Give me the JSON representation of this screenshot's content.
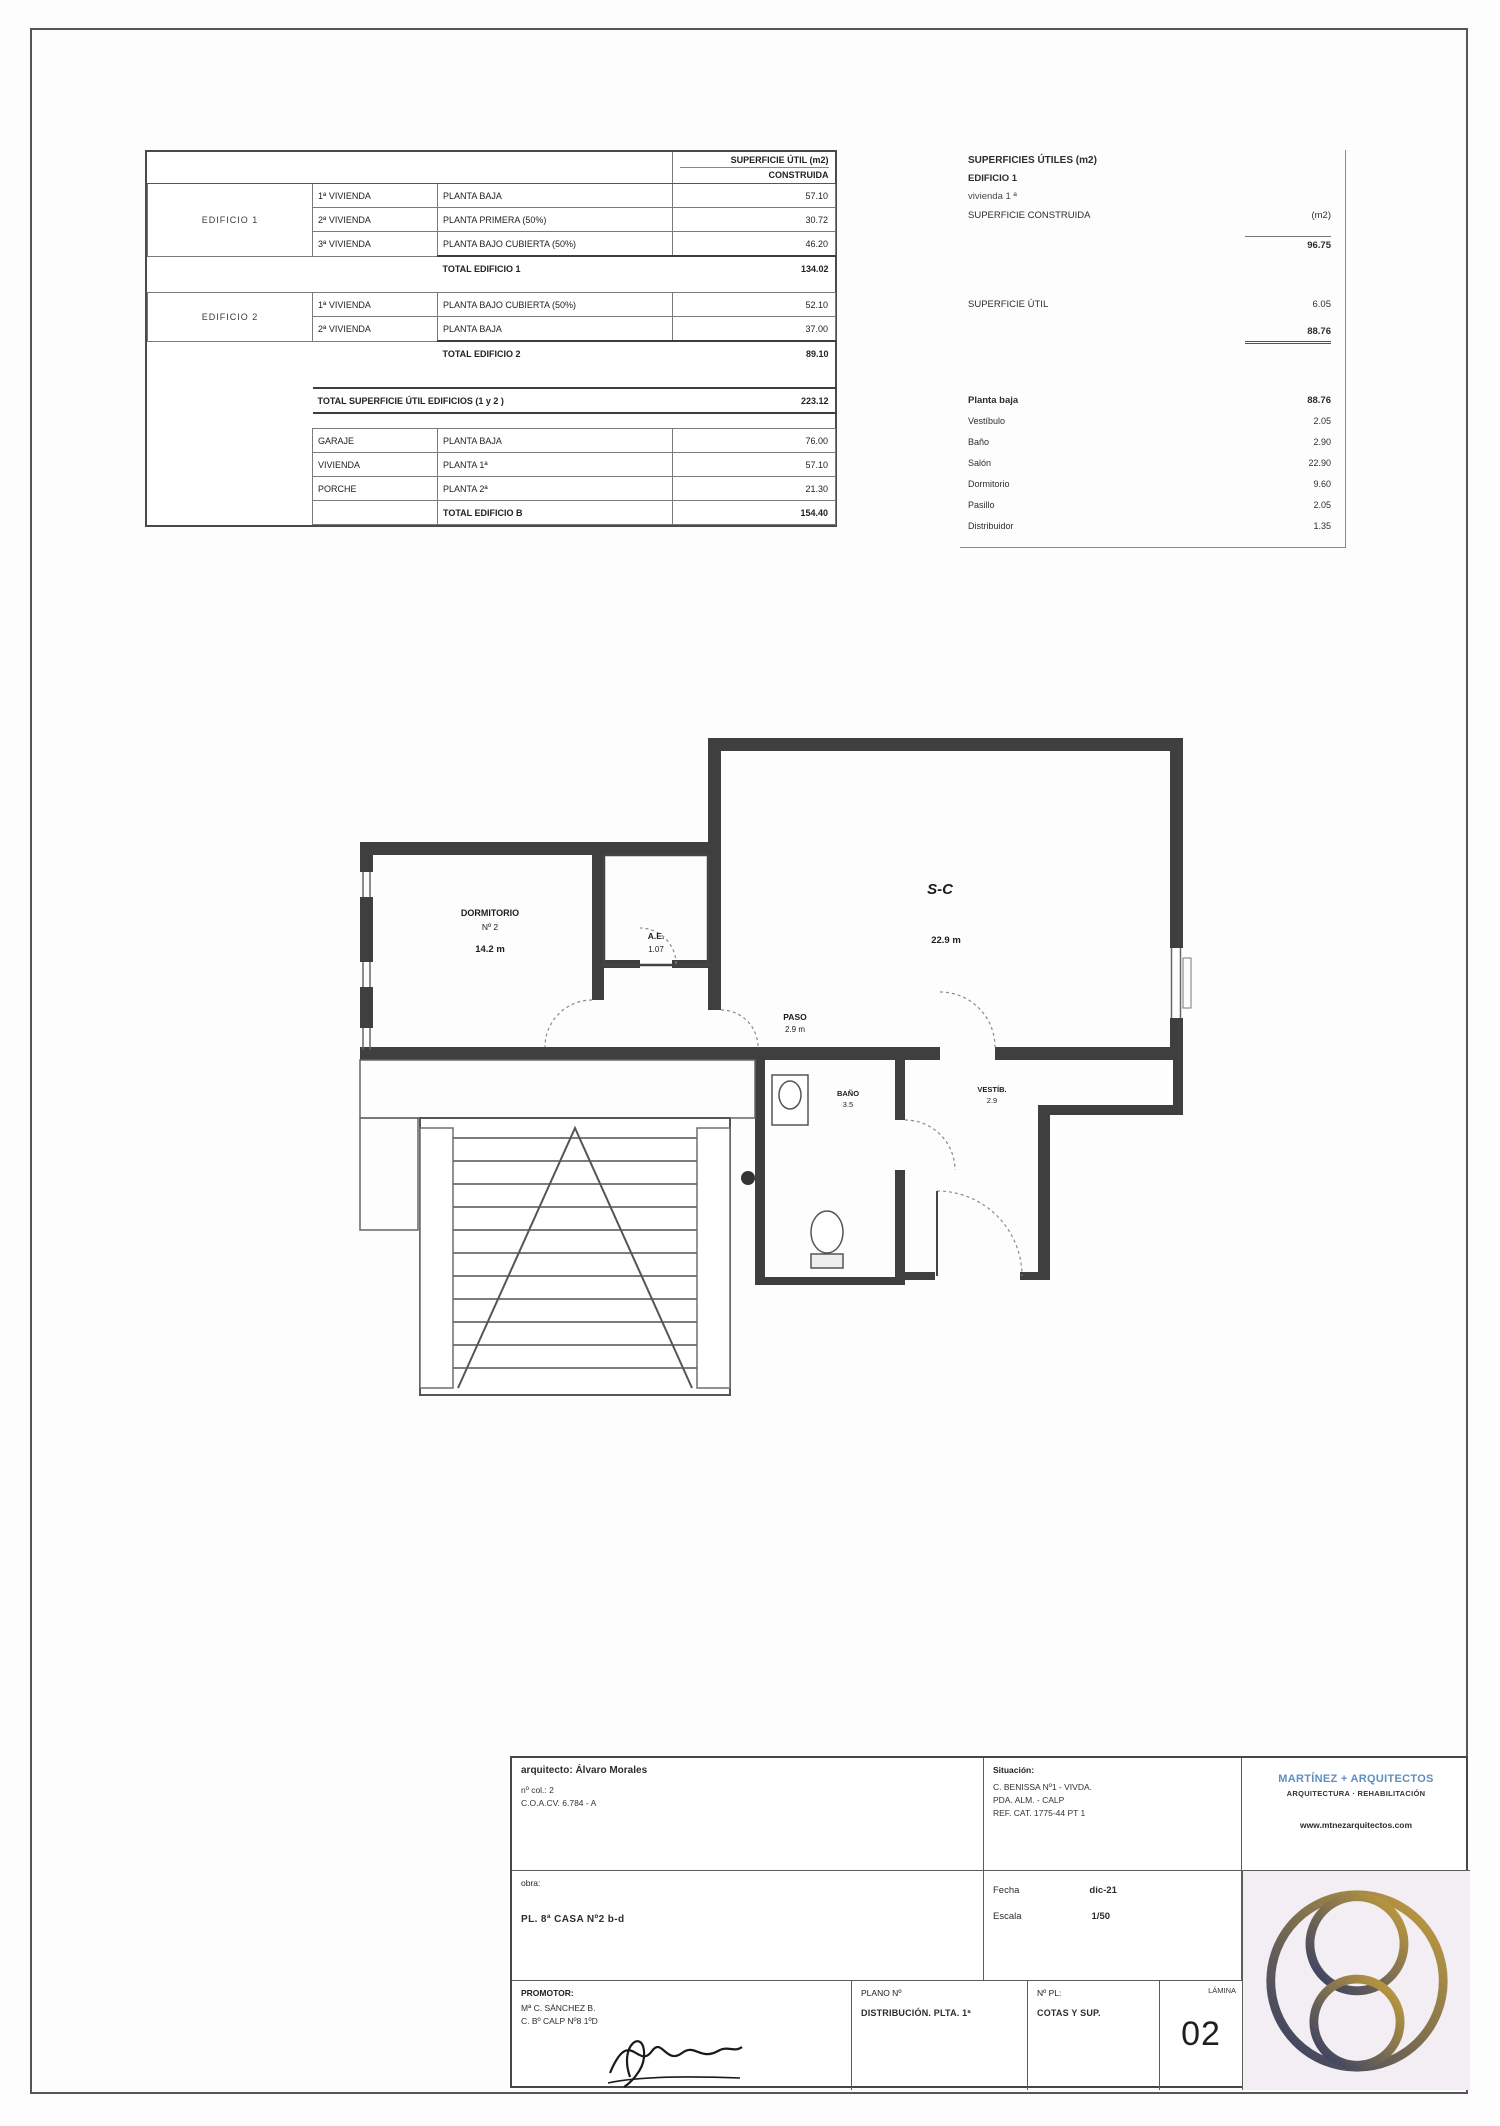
{
  "colors": {
    "firm_blue": "#5f8fc0",
    "logo_gold": "#c9a23b",
    "logo_navy": "#303a66",
    "wall": "#3f3f3f"
  },
  "surface_table": {
    "header": {
      "line1": "SUPERFICIE ÚTIL (m2)",
      "line2": "CONSTRUIDA"
    },
    "sec1": {
      "name": "EDIFICIO 1",
      "r1": {
        "unit": "1ª VIVIENDA",
        "desc": "PLANTA BAJA",
        "value": "57.10"
      },
      "r2": {
        "unit": "2ª VIVIENDA",
        "desc": "PLANTA PRIMERA (50%)",
        "value": "30.72"
      },
      "r3": {
        "unit": "3ª VIVIENDA",
        "desc": "PLANTA BAJO CUBIERTA (50%)",
        "value": "46.20"
      },
      "total_label": "TOTAL EDIFICIO 1",
      "total_value": "134.02"
    },
    "sec2": {
      "name": "EDIFICIO 2",
      "r1": {
        "unit": "1ª VIVIENDA",
        "desc": "PLANTA BAJO CUBIERTA (50%)",
        "value": "52.10"
      },
      "r2": {
        "unit": "2ª VIVIENDA",
        "desc": "PLANTA BAJA",
        "value": "37.00"
      },
      "total_label": "TOTAL EDIFICIO 2",
      "total_value": "89.10"
    },
    "grand": {
      "label": "TOTAL SUPERFICIE ÚTIL EDIFICIOS (1 y 2 )",
      "value": "223.12"
    },
    "annex": {
      "r1": {
        "unit": "GARAJE",
        "desc": "PLANTA BAJA",
        "value": "76.00"
      },
      "r2": {
        "unit": "VIVIENDA",
        "desc": "PLANTA 1ª",
        "value": "57.10"
      },
      "r3": {
        "unit": "PORCHE",
        "desc": "PLANTA 2ª",
        "value": "21.30"
      },
      "total_label": "TOTAL EDIFICIO B",
      "total_value": "154.40"
    }
  },
  "summary": {
    "title": "SUPERFICIES ÚTILES (m2)",
    "building": "EDIFICIO 1",
    "unit": "vivienda 1 ª",
    "constructed_label": "SUPERFICIE CONSTRUIDA",
    "constructed_unit": "(m2)",
    "constructed_value": "96.75",
    "useful_label": "SUPERFICIE ÚTIL",
    "useful_value": "6.05",
    "useful_total": "88.76",
    "rooms_header": {
      "label": "Planta baja",
      "value": "88.76"
    },
    "rooms": [
      {
        "label": "Vestíbulo",
        "value": "2.05"
      },
      {
        "label": "Baño",
        "value": "2.90"
      },
      {
        "label": "Salón",
        "value": "22.90"
      },
      {
        "label": "Dormitorio",
        "value": "9.60"
      },
      {
        "label": "Pasillo",
        "value": "2.05"
      },
      {
        "label": "Distribuidor",
        "value": "1.35"
      }
    ]
  },
  "plan": {
    "labels": {
      "room_name": "DORMITORIO",
      "room_no": "Nº 2",
      "room_area": "14.2 m",
      "closet_1": "A.E.",
      "closet_2": "1.07",
      "pass_1": "PASO",
      "pass_2": "2.9 m",
      "salon_1": "S-C",
      "salon_2": "22.9 m",
      "bath_1": "BAÑO",
      "bath_2": "3.5",
      "hall_1": "VESTÍB.",
      "hall_2": "2.9"
    }
  },
  "titleblock": {
    "architect": {
      "line1": "arquitecto: Álvaro Morales",
      "line2": "nº col.: 2",
      "line3": "C.O.A.CV. 6.784 - A"
    },
    "obra": {
      "label": "obra:",
      "line": "PL. 8ª CASA Nº2 b-d"
    },
    "situacion": {
      "label": "Situación:",
      "line1": "C. BENISSA Nº1 - VIVDA.",
      "line2": "PDA. ALM. - CALP",
      "line3": "REF. CAT. 1775-44 PT 1"
    },
    "meta": {
      "date_label": "Fecha",
      "date_value": "dic-21",
      "scale_label": "Escala",
      "scale_value": "1/50"
    },
    "firm": {
      "name": "MARTÍNEZ + ARQUITECTOS",
      "tagline": "ARQUITECTURA · REHABILITACIÓN",
      "web": "www.mtnezarquitectos.com"
    },
    "promotor": {
      "label": "PROMOTOR:",
      "line1": "Mª C. SÁNCHEZ B.",
      "line2": "C. Bº CALP Nº8 1ºD"
    },
    "plano": {
      "label": "PLANO Nº",
      "value": "DISTRIBUCIÓN. PLTA. 1ª"
    },
    "detalle": {
      "label": "Nº PL:",
      "value": "COTAS Y SUP."
    },
    "lamina": {
      "label": "LÁMINA",
      "value": "02"
    }
  }
}
